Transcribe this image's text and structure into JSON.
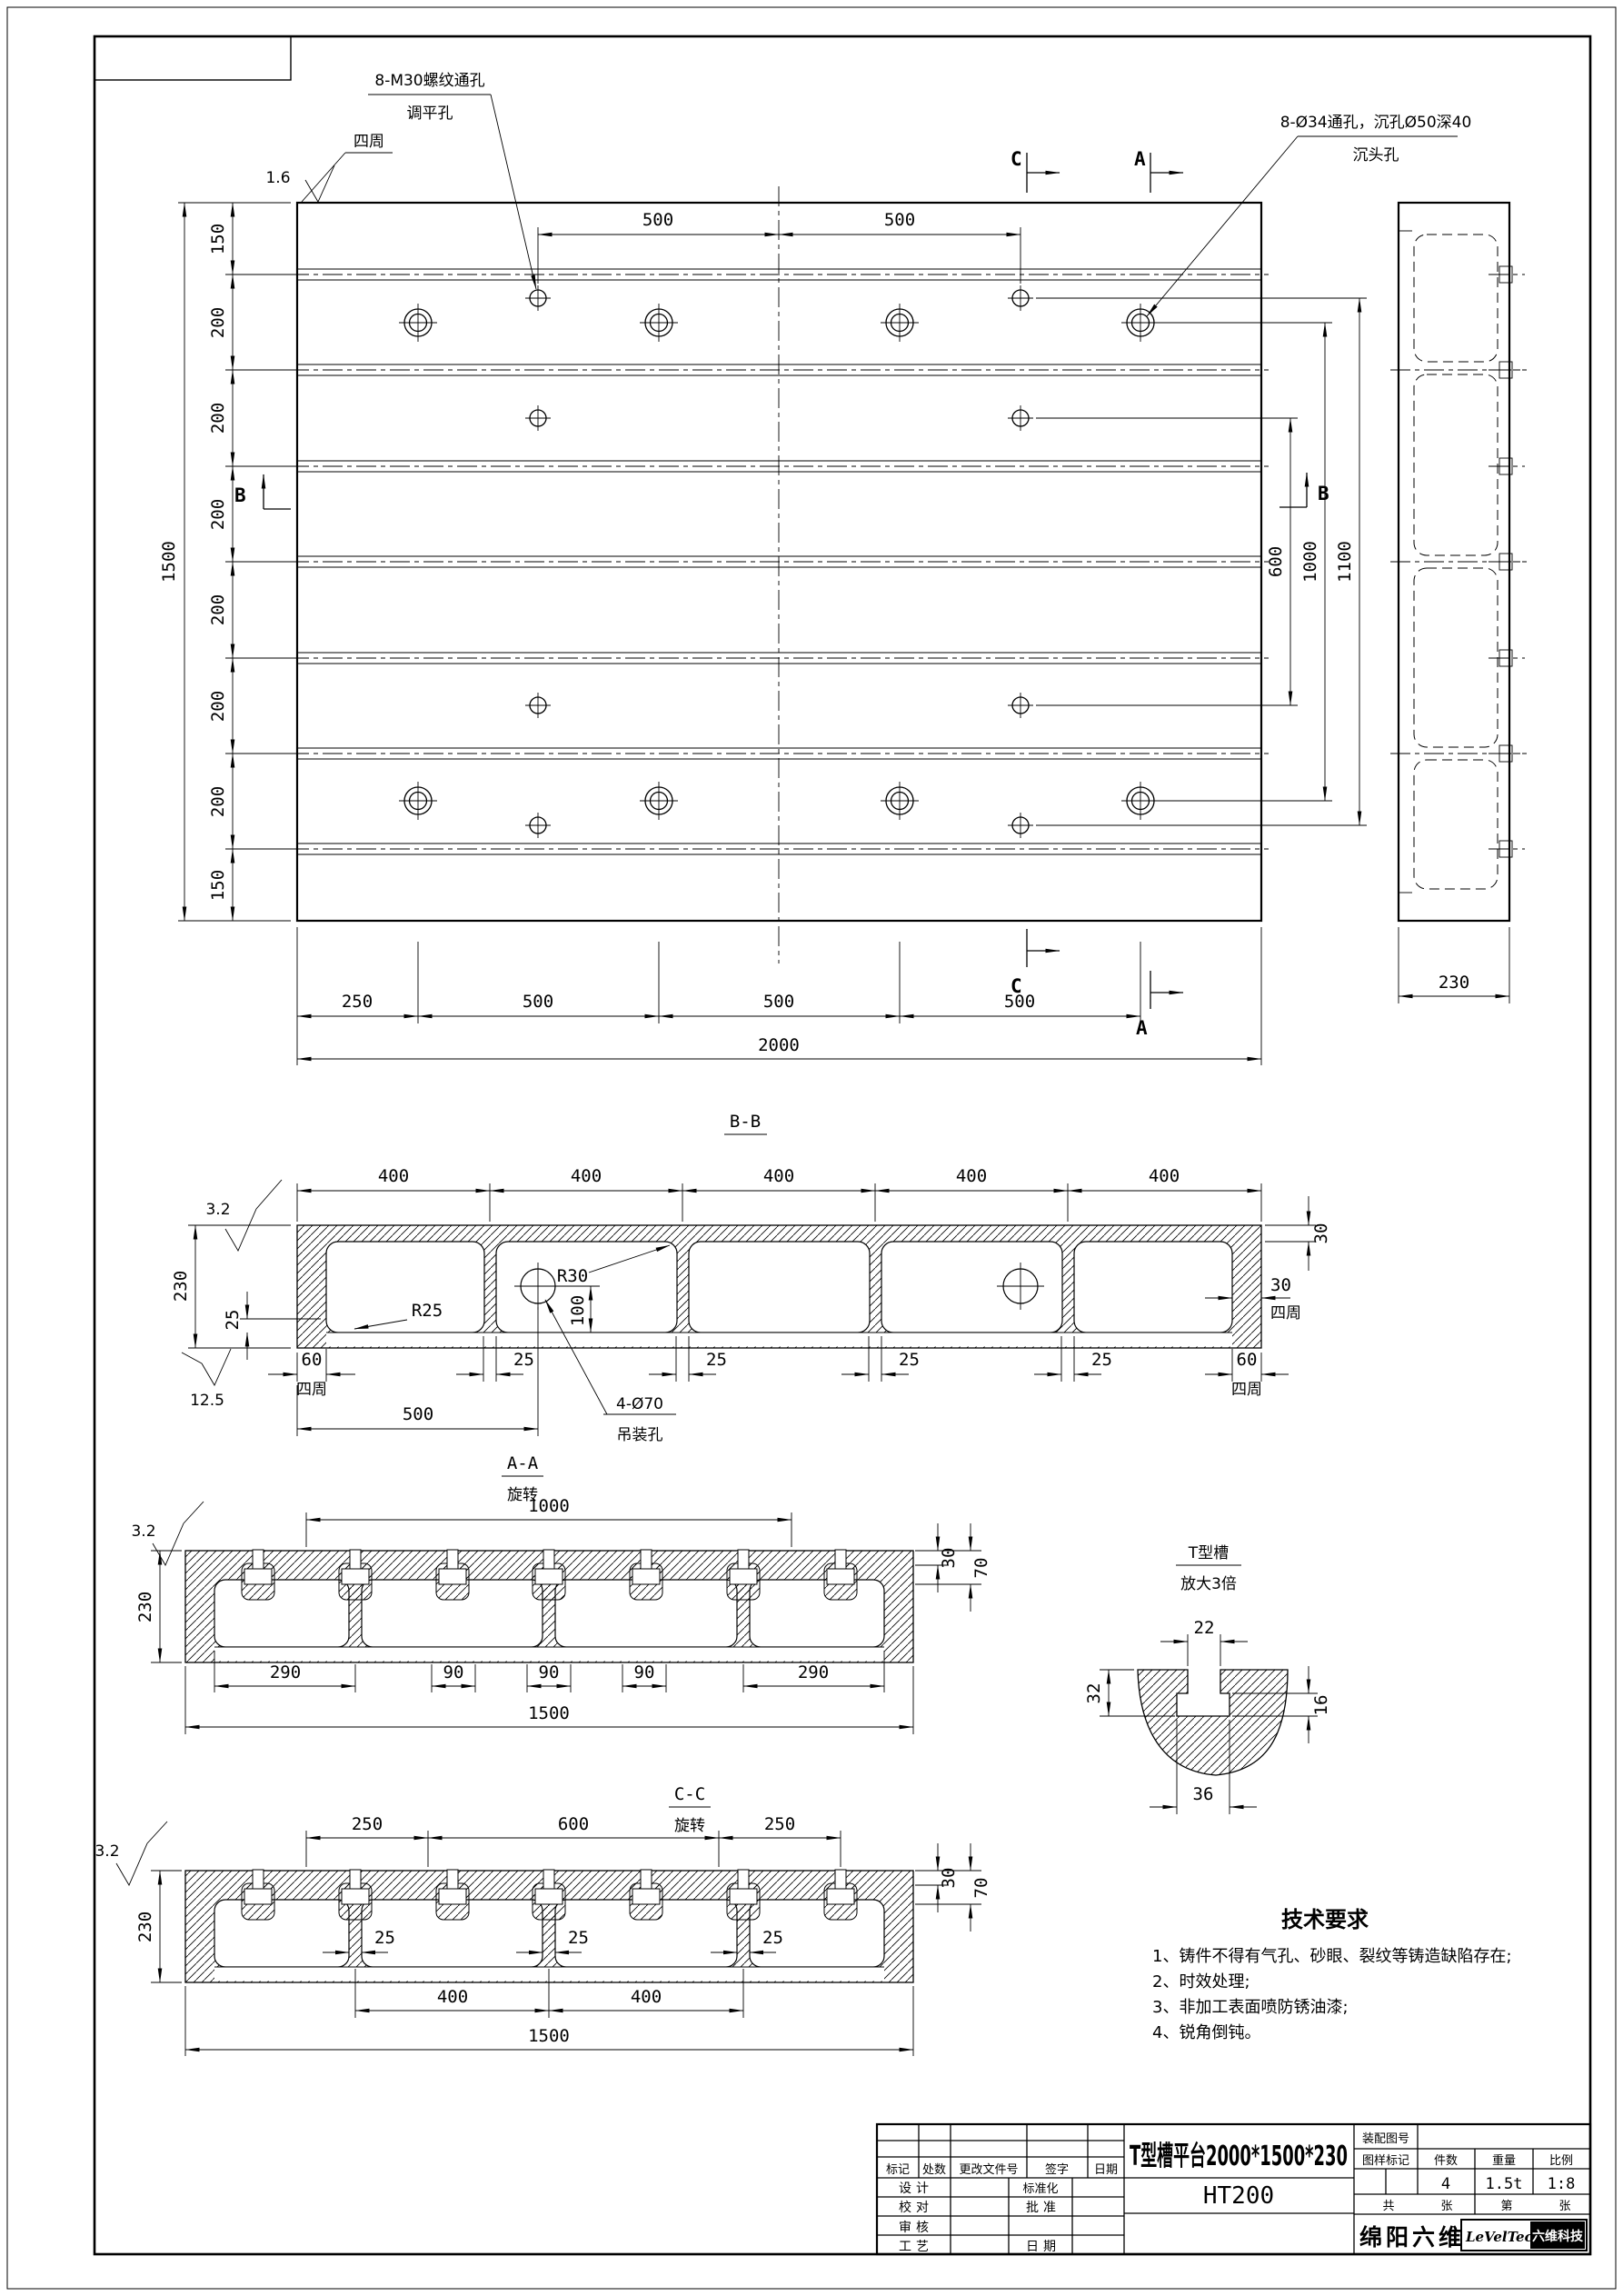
{
  "plan": {
    "leader_m30": {
      "line1": "8-M30螺纹通孔",
      "line2": "调平孔"
    },
    "leader_c34": {
      "line1": "8-Ø34通孔，沉孔Ø50深40",
      "line2": "沉头孔"
    },
    "finish_value": "1.6",
    "finish_scope": "四周",
    "dim_top_1": "500",
    "dim_top_2": "500",
    "marker_a": "A",
    "marker_b": "B",
    "marker_c": "C",
    "dim_left": [
      "150",
      "200",
      "200",
      "200",
      "200",
      "200",
      "200",
      "150"
    ],
    "dim_left_total": "1500",
    "dim_right": [
      "600",
      "1000",
      "1100"
    ],
    "dim_bottom": [
      "250",
      "500",
      "500",
      "500"
    ],
    "dim_bottom_total": "2000",
    "side_dim": "230"
  },
  "bb": {
    "title": "B-B",
    "finish": "3.2",
    "dims_400": [
      "400",
      "400",
      "400",
      "400",
      "400"
    ],
    "dim_230": "230",
    "dim_25": "25",
    "r25": "R25",
    "r30": "R30",
    "dim_30v": "30",
    "dim_30s": "30",
    "scope1": "四周",
    "dim_60l": "60",
    "scope2": "四周",
    "dim_60r": "60",
    "scope3": "四周",
    "rib_dims": [
      "25",
      "25",
      "25",
      "25"
    ],
    "dim_500": "500",
    "dim_100": "100",
    "hole_label1": "4-Ø70",
    "hole_label2": "吊装孔",
    "finish2": "12.5",
    "sub_title": "A-A",
    "sub_note": "旋转"
  },
  "aa": {
    "finish": "3.2",
    "dim_1000": "1000",
    "dim_30": "30",
    "dim_70": "70",
    "dim_230": "230",
    "dims_bottom": [
      "290",
      "90",
      "90",
      "90",
      "290"
    ],
    "dim_total": "1500"
  },
  "tslot": {
    "title": "T型槽",
    "subtitle": "放大3倍",
    "dim_22": "22",
    "dim_32": "32",
    "dim_16": "16",
    "dim_36": "36"
  },
  "cc": {
    "title": "C-C",
    "note": "旋转",
    "finish": "3.2",
    "dims_top": [
      "250",
      "600",
      "250"
    ],
    "dim_30": "30",
    "dim_70": "70",
    "dim_230": "230",
    "rib_dims": [
      "25",
      "25",
      "25"
    ],
    "dims_400": [
      "400",
      "400"
    ],
    "dim_total": "1500"
  },
  "tech": {
    "title": "技术要求",
    "items": [
      "1、铸件不得有气孔、砂眼、裂纹等铸造缺陷存在;",
      "2、时效处理;",
      "3、非加工表面喷防锈油漆;",
      "4、锐角倒钝。"
    ]
  },
  "tb": {
    "part_title": "T型槽平台2000*1500*230",
    "material": "HT200",
    "rev_headers": [
      "标记",
      "处数",
      "更改文件号",
      "签字",
      "日期"
    ],
    "design": "设计",
    "standardize": "标准化",
    "proof": "校对",
    "approve": "批准",
    "review": "审核",
    "process": "工艺",
    "date": "日期",
    "assembly_no": "装配图号",
    "mark": "图样标记",
    "qty_label": "件数",
    "weight_label": "重量",
    "scale_label": "比例",
    "qty": "4",
    "weight": "1.5t",
    "scale": "1:8",
    "total_label": "共",
    "sheet_label": "张",
    "no_label": "第",
    "sheet_label2": "张",
    "company": "绵阳六维",
    "logo_text": "LeVelTech",
    "logo_text2": "六维科技"
  }
}
